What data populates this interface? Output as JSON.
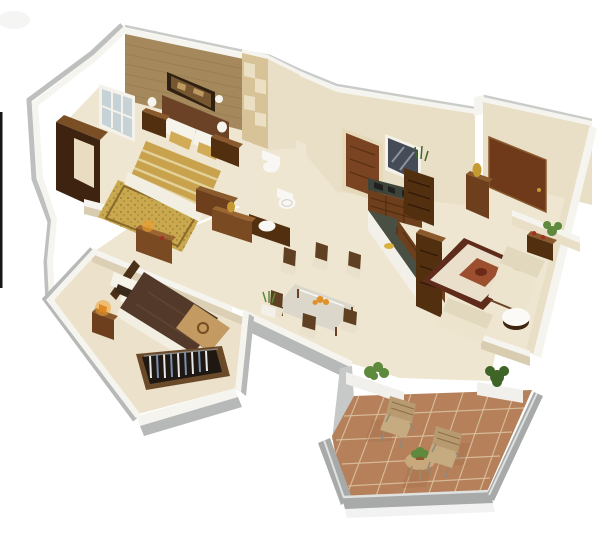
{
  "meta": {
    "description": "Photorealistic 3D isometric cutaway floor-plan render of a two-bedroom apartment with kitchen, bathroom, living-dining area and tiled balcony, on a white background",
    "render_style": "isometric-3d-cutaway",
    "image_width": 604,
    "image_height": 536
  },
  "scene": {
    "rooms": [
      {
        "id": "master-bedroom",
        "features": [
          "double-bed-gold-bedding",
          "wood-headboard",
          "wall-art",
          "wall-sconces",
          "nightstands-with-lamps",
          "gold-rug",
          "dark-wardrobe",
          "window"
        ]
      },
      {
        "id": "second-bedroom",
        "features": [
          "double-bed-chocolate-bedding",
          "tan-foot-runner",
          "open-wardrobe-with-clothes",
          "nightstand-warm-lamp",
          "dresser-with-lamp"
        ]
      },
      {
        "id": "bathroom",
        "features": [
          "toilet",
          "wc",
          "round-basin-on-wood-counter"
        ]
      },
      {
        "id": "kitchen",
        "features": [
          "wood-door",
          "dark-window",
          "counter-with-appliances",
          "granite-island",
          "shelf-unit-with-plant"
        ]
      },
      {
        "id": "entry-foyer",
        "features": [
          "entry-door",
          "shoe-cabinet-with-gold-vase"
        ]
      },
      {
        "id": "living-room",
        "features": [
          "bordered-rug-with-medallion",
          "beige-sofa-set",
          "round-white-table",
          "tv-unit",
          "side-table",
          "corner-plant"
        ]
      },
      {
        "id": "dining-area",
        "features": [
          "glass-dining-table",
          "six-wood-chairs",
          "fruit-bowl",
          "potted-plant"
        ]
      },
      {
        "id": "balcony",
        "features": [
          "terracotta-tile-floor",
          "gray-parapet-walls",
          "white-planters-with-plants",
          "two-chairs",
          "round-table-with-plant"
        ]
      }
    ]
  },
  "palette": {
    "bg": "#ffffff",
    "smudge": "#e9e9e7",
    "outerEdge": "#c9ccc9",
    "wallTop": "#f5f4ee",
    "wallFace": "#e9dfc6",
    "wallShade": "#d8ccb1",
    "wallOuter": "#b6b9b7",
    "floor": "#efe6d1",
    "floorBR2": "#ece1ca",
    "bathCol": "#eee6d2",
    "headboardWall": "#a5895c",
    "headboardLine": "#8e754a",
    "panelCream": "#d8c297",
    "panelLight": "#ece0c4",
    "artFrame": "#2f2012",
    "artCanvas": "#77572f",
    "artDetail": "#c8a269",
    "sconce": "#f6f4ec",
    "frameWhite": "#f4f2ea",
    "windowGlass": "#c6d2d6",
    "wardrobeDark": "#3e2410",
    "wardrobeTop": "#7a4f26",
    "wardrobeInner": "#e9dcc0",
    "woodDark": "#52300f",
    "woodMid": "#6e3f1d",
    "woodTop": "#8a5a2c",
    "doorFrame": "#e6d9ba",
    "doorBrown": "#7a4423",
    "doorLine": "#5c3012",
    "entryDoor": "#6e3a19",
    "entryFrame": "#8a5a30",
    "glassDark": "#454c58",
    "glassReflect": "#aab2bd",
    "duvetGold": "#c8a24c",
    "duvetStripe": "#e8d9a8",
    "pillowWhite": "#f6f3ea",
    "accentGold": "#d2ab57",
    "footWhite": "#f2eee2",
    "rugGold": "#c9a84e",
    "rugBorder1": "#8a6a2a",
    "speck": "#6b501e",
    "fixtureWhite": "#f8f7f3",
    "fixtureShade": "#d8d5cc",
    "counterTop": "#3f443a",
    "appliance": "#1d1d1d",
    "drawerLine": "#4f2a10",
    "granite": "#4a4f44",
    "islandWhite": "#f2f0e9",
    "shelfLine": "#2f180a",
    "plate": "#d9b13c",
    "gold": "#c59a33",
    "sofaBack": "#e2d8bd",
    "sofaSeat": "#ece4cd",
    "sofaWood": "#6b4226",
    "rugBorder2": "#5f2c1c",
    "rugField": "#e9dfca",
    "rugMedallion": "#9c4f2e",
    "rugCenter": "#6e2a18",
    "tableWhite": "#fbfaf6",
    "tableBase": "#3f2410",
    "redAccent": "#a03020",
    "plantGreen": "#5d8a3c",
    "plantDark": "#3f6428",
    "glassTable": "#d9d6c9",
    "glassHi": "#ffffff",
    "chairWood": "#5f4022",
    "chairCushion": "#e9e1cc",
    "orange": "#e09028",
    "chocolate": "#53392a",
    "chocSeam": "#6a4e38",
    "tanFoot": "#c39a62",
    "emblem": "#7a4a20",
    "darkPillow": "#3a2a1c",
    "headboard2": "#4a3018",
    "closetBlack": "#1f1711",
    "closetFrame": "#6b4a2a",
    "clothesWhite": "#e8e8e8",
    "clothesBlue": "#7a90b0",
    "rail": "#8a8a8a",
    "lampGlow": "#f0a030",
    "lampBody": "#e08820",
    "dresser2": "#7a4a22",
    "dresser2Top": "#9a6530",
    "tileTerra": "#b5805a",
    "tileGrout": "#d9c09f",
    "tileDark": "#a26a46",
    "parapetGray": "#a7aaa9",
    "parapetTop": "#e0e2e1",
    "parapetFace": "#c6c9c7",
    "planterWhite": "#f1f0ec",
    "balcChair": "#b89a70",
    "balcCushion": "#c6ab80",
    "balcStripe": "#8a6f48",
    "metal": "#8f8a7d",
    "tableWood": "#c9a87c",
    "tableLeg": "#9a8a6a",
    "pot": "#8a5a30",
    "artifact": "#161616",
    "shadow": "#000000"
  }
}
